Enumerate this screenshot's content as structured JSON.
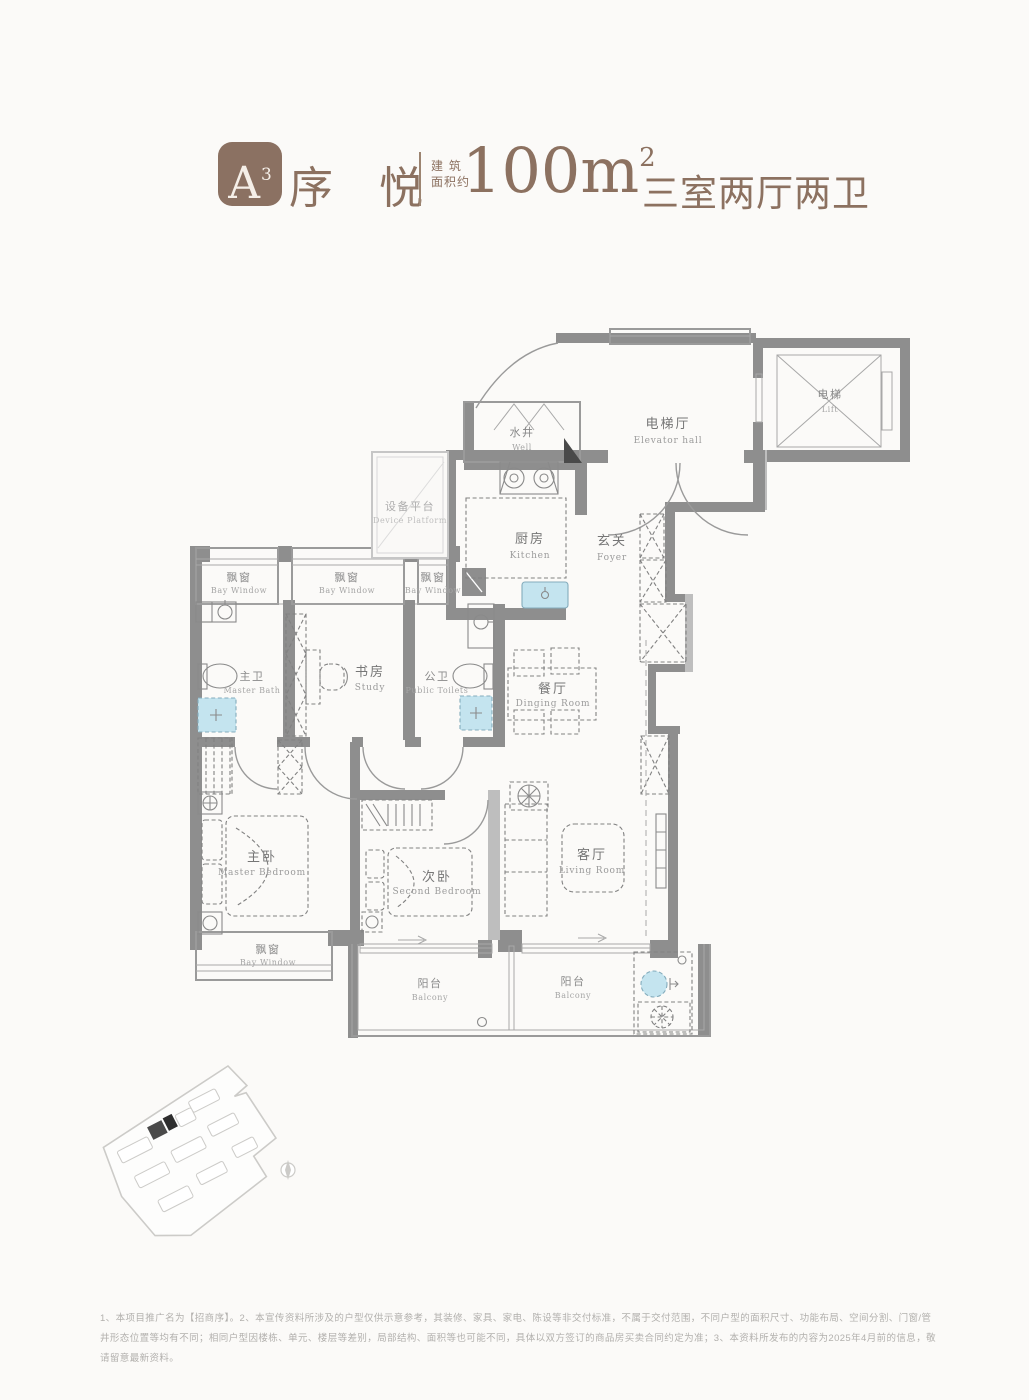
{
  "header": {
    "badge_text": "A",
    "badge_sup": "3",
    "title": "序 悦",
    "area_label_line1": "建 筑",
    "area_label_line2": "面积约",
    "area_value": "100m",
    "area_sup": "2",
    "spec": "三室两厅两卫",
    "accent_color": "#8B7162"
  },
  "plan": {
    "wall_color": "#8E8E8E",
    "fixture_blue": "#C4E4EF",
    "rooms": {
      "well": {
        "zh": "水井",
        "en": "Well"
      },
      "elevator_hall": {
        "zh": "电梯厅",
        "en": "Elevator hall"
      },
      "lift": {
        "zh": "电梯",
        "en": "Lift"
      },
      "device_platform": {
        "zh": "设备平台",
        "en": "Device Platform"
      },
      "kitchen": {
        "zh": "厨房",
        "en": "Kitchen"
      },
      "foyer": {
        "zh": "玄关",
        "en": "Foyer"
      },
      "bay_window": {
        "zh": "飘窗",
        "en": "Bay Window"
      },
      "master_bath": {
        "zh": "主卫",
        "en": "Master Bath"
      },
      "study": {
        "zh": "书房",
        "en": "Study"
      },
      "public_toilet": {
        "zh": "公卫",
        "en": "Public Toilets"
      },
      "dining_room": {
        "zh": "餐厅",
        "en": "Dinging Room"
      },
      "master_bedroom": {
        "zh": "主卧",
        "en": "Master Bedroom"
      },
      "second_bedroom": {
        "zh": "次卧",
        "en": "Second Bedroom"
      },
      "living_room": {
        "zh": "客厅",
        "en": "Living Room"
      },
      "balcony": {
        "zh": "阳台",
        "en": "Balcony"
      }
    }
  },
  "footer": {
    "disclaimer": "1、本项目推广名为【招商序】。2、本宣传资料所涉及的户型仅供示意参考，其装修、家具、家电、陈设等非交付标准，不属于交付范围，不同户型的面积尺寸、功能布局、空间分割、门窗/管井形态位置等均有不同；相同户型因楼栋、单元、楼层等差别，局部结构、面积等也可能不同，具体以双方签订的商品房买卖合同约定为准；3、本资料所发布的内容为2025年4月前的信息，敬请留意最新资料。"
  }
}
